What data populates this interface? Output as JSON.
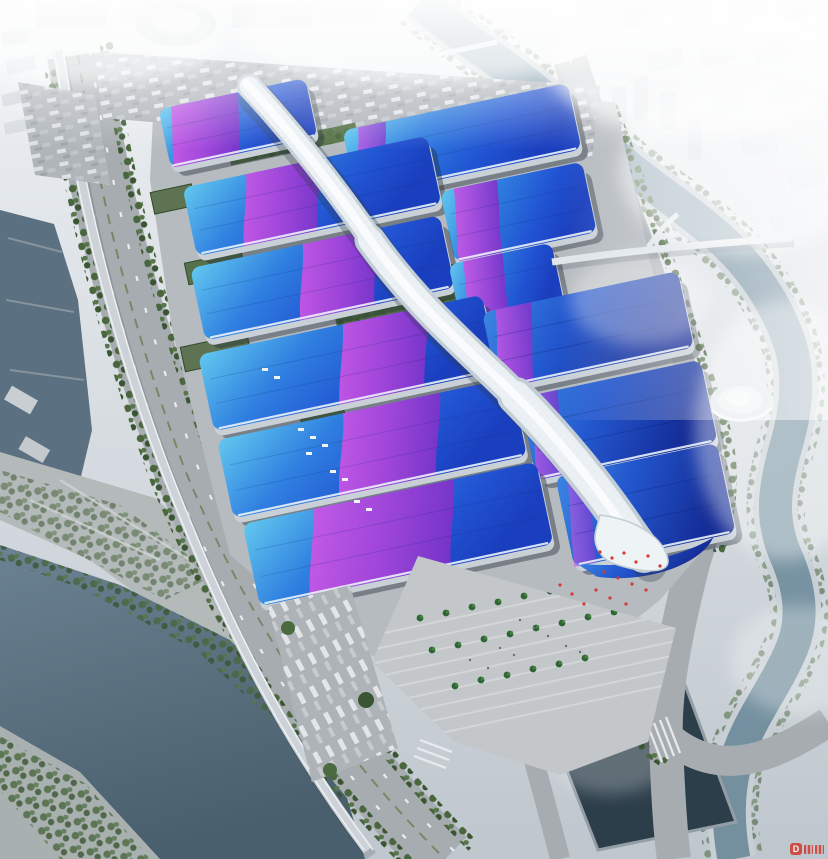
{
  "watermark": {
    "letter": "D"
  },
  "palette": {
    "sky_top": "#eef1f4",
    "sky_bottom": "#bfc7ce",
    "haze": "#ffffff",
    "roof_cyan": "#62c8ef",
    "roof_blue": "#2f7fe0",
    "roof_deep": "#1a3fbe",
    "roof_indigo": "#142c96",
    "ribbon_magenta": "#d55ae8",
    "ribbon_violet": "#7b32c8",
    "spine_light": "#f3f8fb",
    "spine_shade": "#c2cdd5",
    "water_pond": "#2c3e4a",
    "water_canal": "#5b7080",
    "water_river": "#8aa2b1",
    "ground": "#b6bbc0",
    "road": "#a7acb1",
    "plaza": "#c3c7ca",
    "parking": "#aeb3b8",
    "green_dark": "#3f5e35",
    "green_mid": "#55744a",
    "tree": "#46633c",
    "facade": "#c9d1d7",
    "shadow": "#273039",
    "watermark_red": "#d03a2e",
    "flag_red": "#d23b30"
  }
}
